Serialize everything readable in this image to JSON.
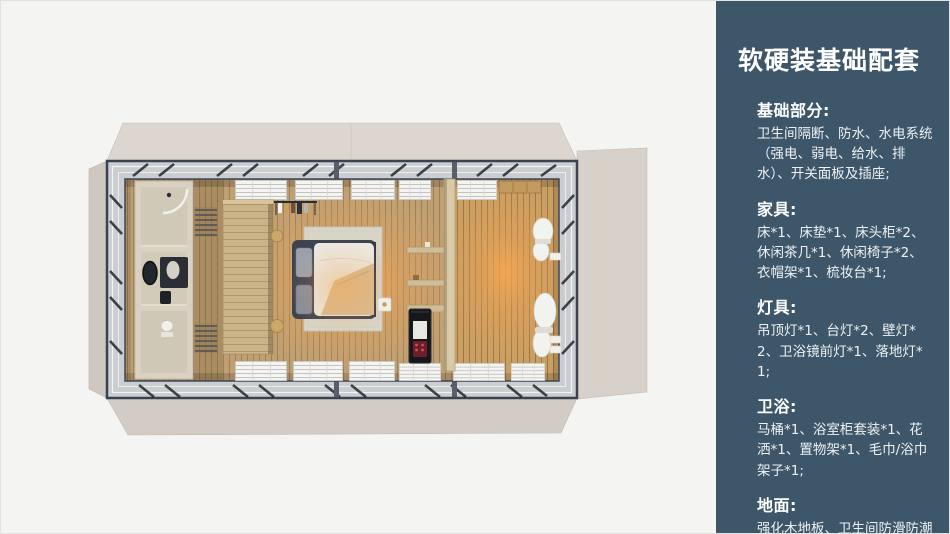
{
  "panel": {
    "title": "软硬装基础配套",
    "sections": [
      {
        "heading": "基础部分:",
        "body": "卫生间隔断、防水、水电系统（强电、弱电、给水、排水）、开关面板及插座;"
      },
      {
        "heading": "家具:",
        "body": "床*1、床垫*1、床头柜*2、休闲茶几*1、休闲椅子*2、衣帽架*1、梳妆台*1;"
      },
      {
        "heading": "灯具:",
        "body": "吊顶灯*1、台灯*2、壁灯*2、卫浴镜前灯*1、落地灯*1;"
      },
      {
        "heading": "卫浴:",
        "body": "马桶*1、浴室柜套装*1、花洒*1、置物架*1、毛巾/浴巾架子*1;"
      },
      {
        "heading": "地面:",
        "body": "强化木地板、卫生间防滑防潮石塑板;"
      }
    ],
    "colors": {
      "panel_bg": "#3d5669",
      "heading_text": "#ffffff",
      "body_text": "#edf1f4"
    }
  },
  "slide": {
    "background": "#f4f4f3",
    "floorplan_colors": {
      "container_flap": "#d7d0c8",
      "wood_floor": "#bfa073",
      "warm_glow": "#f0a050",
      "frame_metal": "#3a4150",
      "bathroom_walls": "#d9d2c3"
    }
  }
}
